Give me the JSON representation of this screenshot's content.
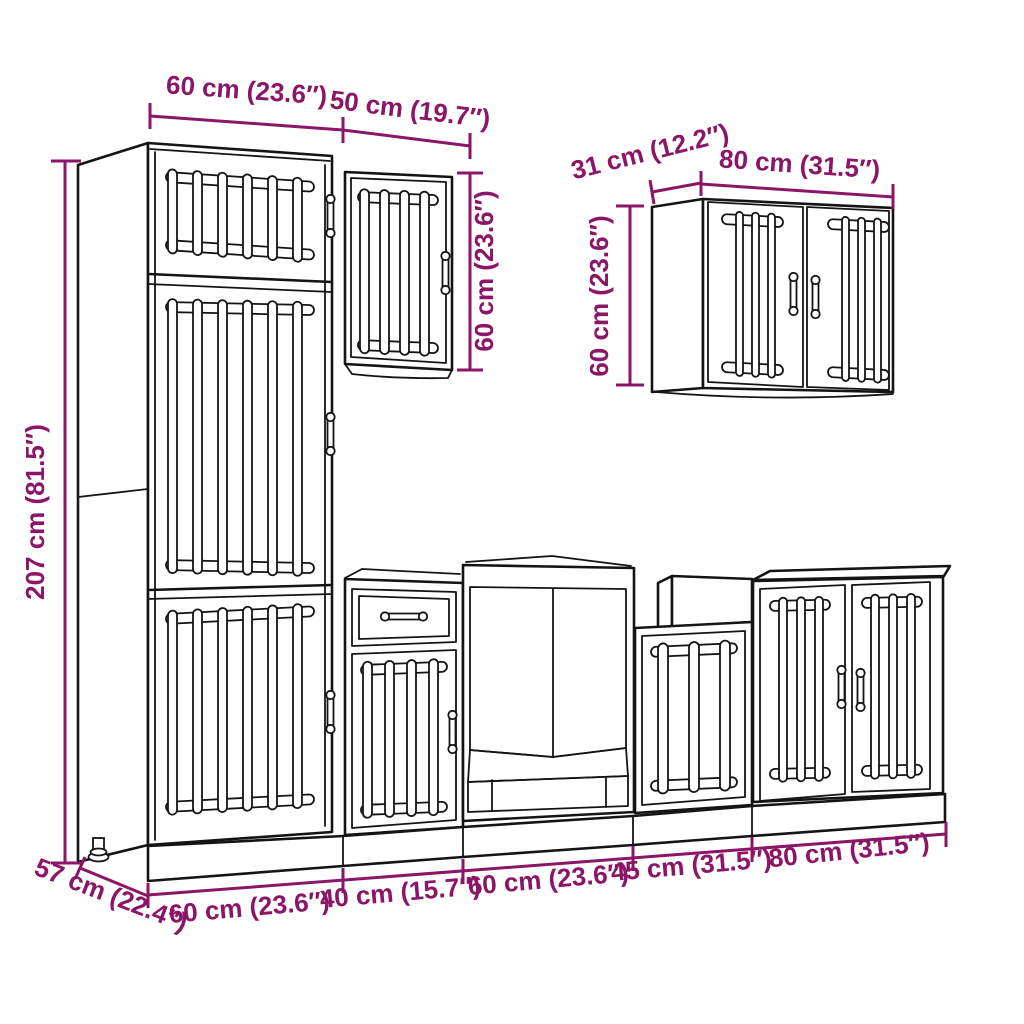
{
  "title": "7-piece kitchen cabinet set dimension diagram",
  "colors": {
    "dimension_accent": "#8B1566",
    "drawing_line": "#141414",
    "background": "#ffffff"
  },
  "dimensions": {
    "top_tall_width": "60 cm (23.6″)",
    "top_wall50_width": "50 cm (19.7″)",
    "wall50_height": "60 cm (23.6″)",
    "wall80_depth": "31 cm (12.2″)",
    "wall80_width": "80 cm (31.5″)",
    "wall80_height": "60 cm (23.6″)",
    "tall_height": "207 cm (81.5″)",
    "base_depth": "57 cm (22.4″)",
    "base_widths": [
      "60 cm (23.6″)",
      "40 cm (15.7″)",
      "60 cm (23.6″)",
      "45 cm (31.5″)",
      "80 cm (31.5″)"
    ]
  },
  "drawing": {
    "parts": [
      "tall-cabinet",
      "wall-cabinet-50",
      "wall-cabinet-80",
      "base-cabinet-40-drawer",
      "oven-cabinet-60",
      "base-cabinet-45",
      "base-cabinet-80",
      "plinth",
      "adjustable-leg"
    ]
  }
}
